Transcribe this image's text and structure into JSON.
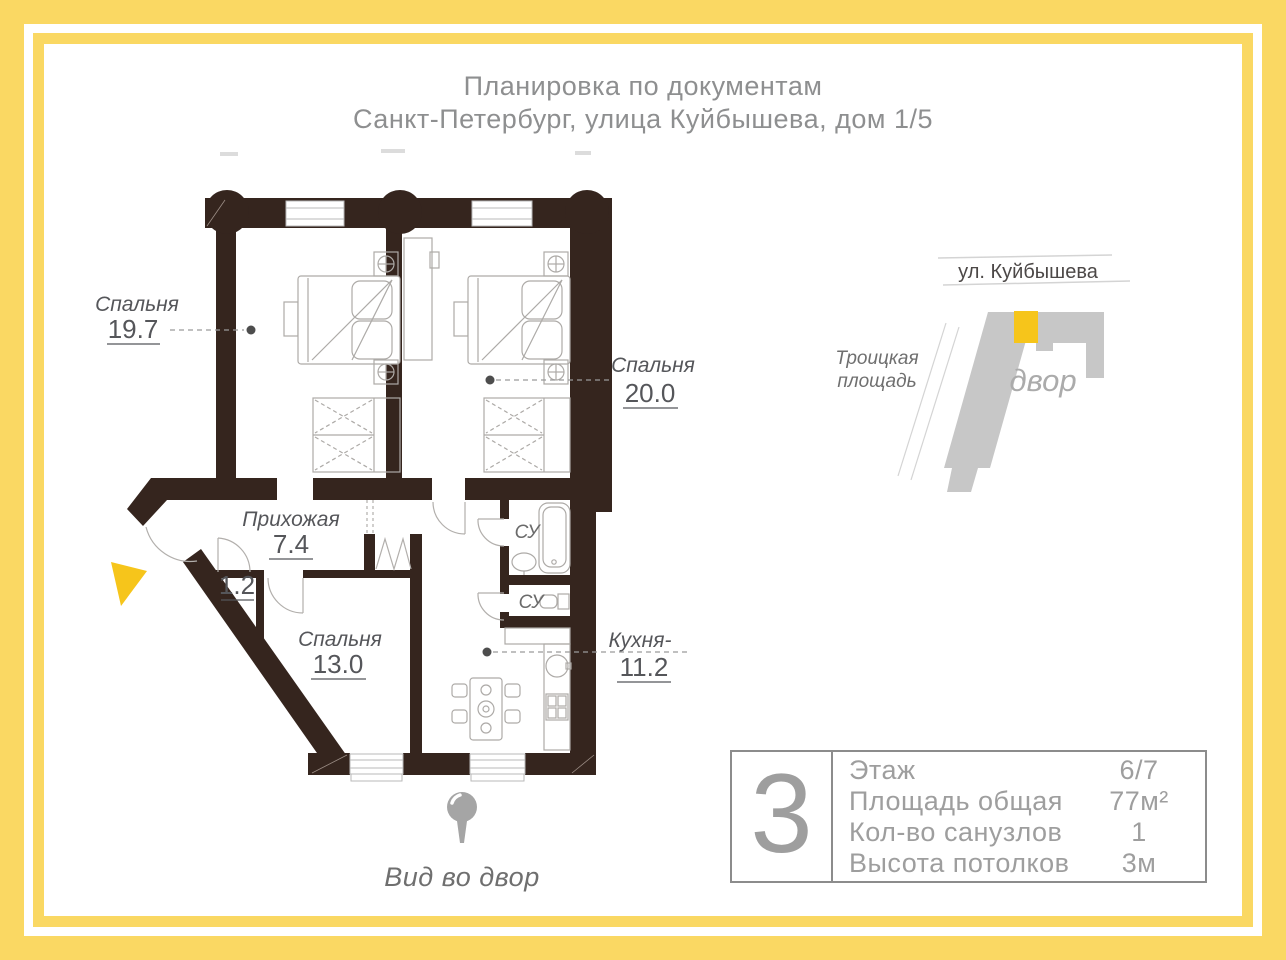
{
  "title": {
    "line1": "Планировка по документам",
    "line2": "Санкт-Петербург, улица Куйбышева, дом 1/5"
  },
  "floor_plan": {
    "rooms": {
      "bedroom1": {
        "name": "Спальня",
        "area": "19.7"
      },
      "bedroom2": {
        "name": "Спальня",
        "area": "20.0"
      },
      "bedroom3": {
        "name": "Спальня",
        "area": "13.0"
      },
      "hallway": {
        "name": "Прихожая",
        "area": "7.4"
      },
      "closet": {
        "area": "1.2"
      },
      "kitchen": {
        "name": "Кухня-",
        "area": "11.2"
      },
      "bathroom1": {
        "abbr": "СУ"
      },
      "bathroom2": {
        "abbr": "СУ"
      }
    },
    "view_label": "Вид во двор"
  },
  "minimap": {
    "street_label": "ул. Куйбышева",
    "square_label_lines": [
      "Троицкая",
      "площадь"
    ],
    "courtyard_label": "двор"
  },
  "info_panel": {
    "rooms_count": "3",
    "rows": [
      {
        "label": "Этаж",
        "value": "6/7"
      },
      {
        "label": "Площадь общая",
        "value": "77м²"
      },
      {
        "label": "Кол-во санузлов",
        "value": "1"
      },
      {
        "label": "Высота потолков",
        "value": "3м"
      }
    ]
  },
  "colors": {
    "frame_yellow": "#FAD863",
    "accent_gold": "#F6C51B",
    "wall_dark": "#35251E",
    "building_gray": "#C7C7C7",
    "title_gray": "#8E8F90",
    "label_gray": "#55565A",
    "info_gray": "#9E9E9E"
  }
}
